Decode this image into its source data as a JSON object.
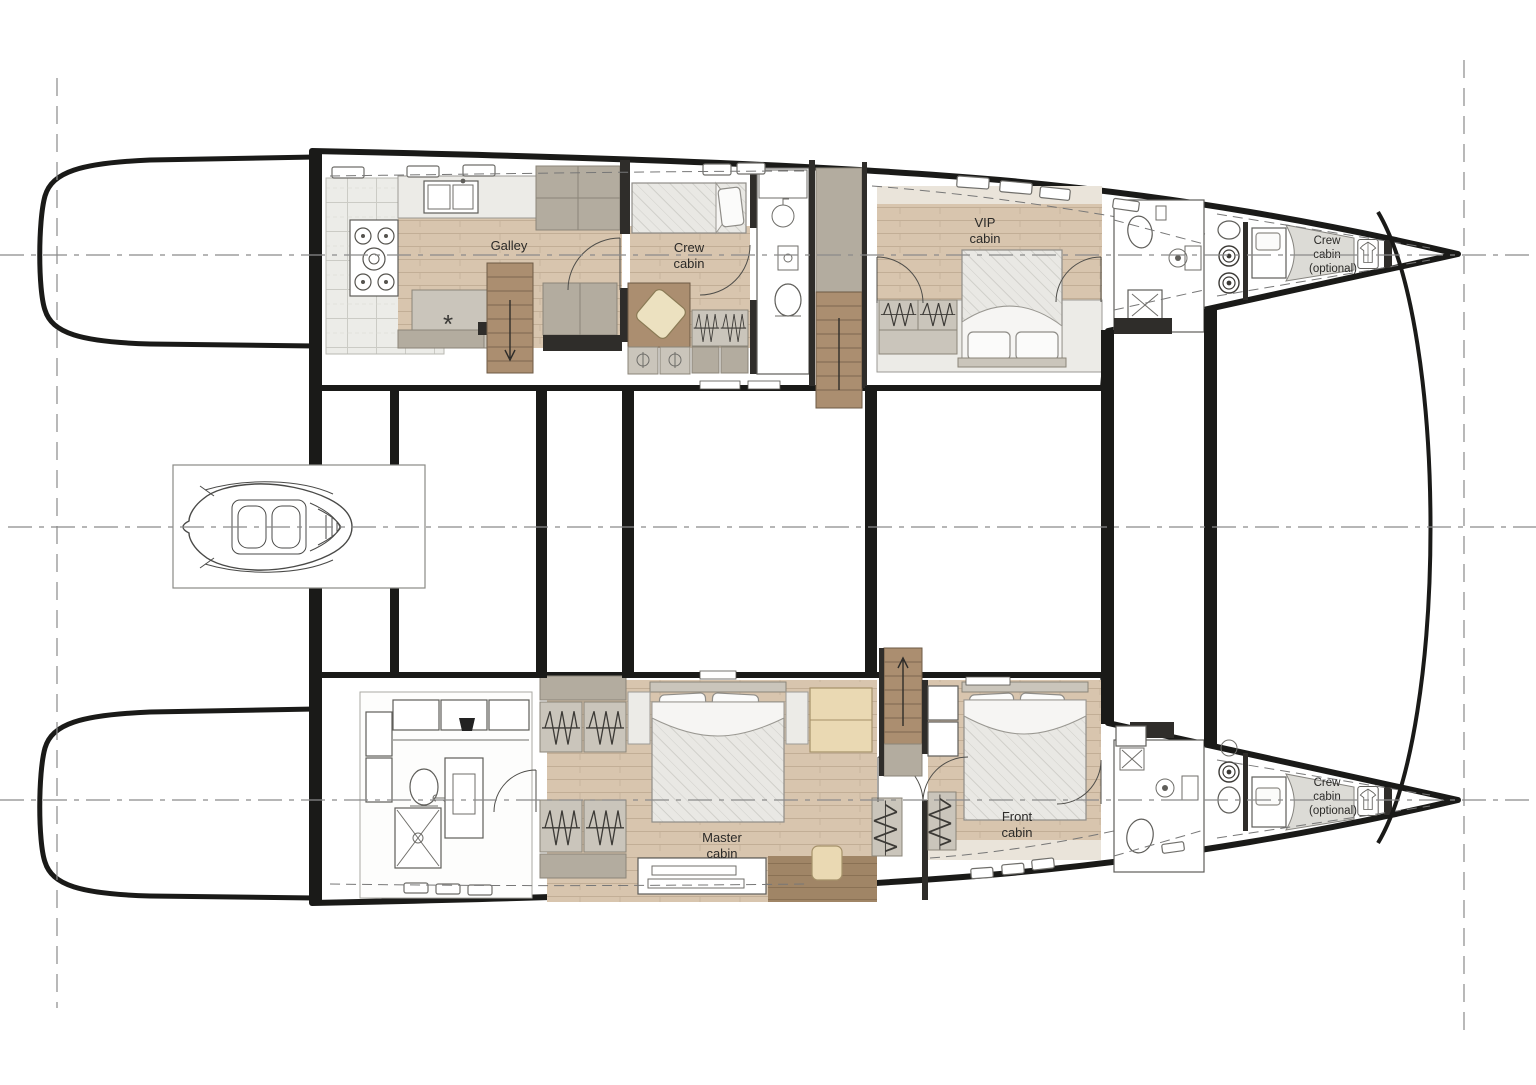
{
  "title": "Catamaran lower deck floor plan",
  "colors": {
    "structure": "#1a1a18",
    "charcoal": "#2f2d2a",
    "wood": "#d8c5ae",
    "woodDark": "#ab8e70",
    "woodDeep": "#a08566",
    "taupe": "#b3ac9f",
    "cabinet": "#cac5bb",
    "light": "#ecebe7",
    "tan": "#ead9b3"
  },
  "rooms": {
    "galley": {
      "label": "Galley"
    },
    "crew_cabin": {
      "line1": "Crew",
      "line2": "cabin"
    },
    "vip_cabin": {
      "line1": "VIP",
      "line2": "cabin"
    },
    "bow_crew_cabin_port": {
      "line1": "Crew",
      "line2": "cabin",
      "line3": "(optional)"
    },
    "master_cabin": {
      "line1": "Master",
      "line2": "cabin"
    },
    "front_cabin": {
      "line1": "Front",
      "line2": "cabin"
    },
    "bow_crew_cabin_starboard": {
      "line1": "Crew",
      "line2": "cabin",
      "line3": "(optional)"
    }
  },
  "symbols": {
    "ceiling_light": "*"
  },
  "icons": {
    "furniture": [
      "double-bed",
      "single-bed",
      "pillow",
      "wardrobe-hanging-rail",
      "washing-machine",
      "stove-4-burner",
      "galley-sink",
      "toilet",
      "washbasin",
      "shower",
      "staircase",
      "sofa-seat",
      "tender-boat",
      "deck-hatch",
      "hanging-shirt",
      "dinette-table"
    ]
  }
}
